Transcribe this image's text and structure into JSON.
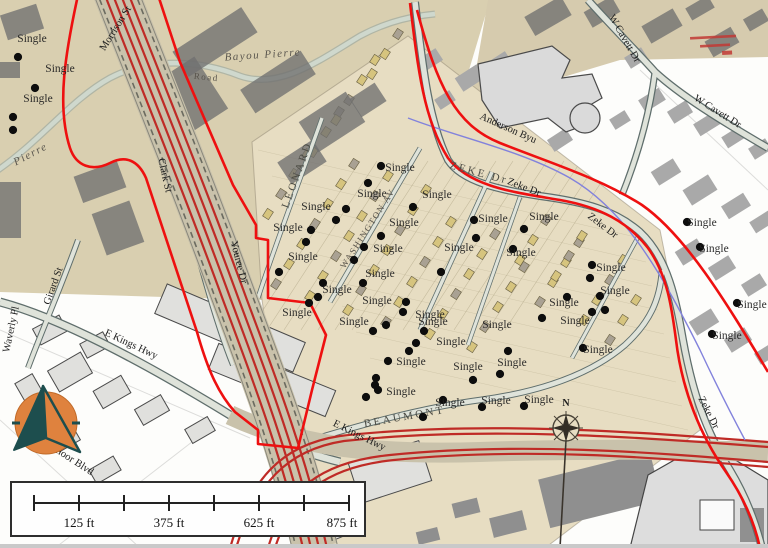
{
  "map": {
    "type": "historic-overlay-gis-map",
    "marker_legend_term": "Single"
  },
  "markers": {
    "label": "Single",
    "points": [
      {
        "x": 18,
        "y": 57,
        "lx": 32,
        "ly": 42
      },
      {
        "x": 35,
        "y": 88,
        "lx": 60,
        "ly": 72
      },
      {
        "x": 13,
        "y": 117,
        "lx": 38,
        "ly": 102
      },
      {
        "x": 13,
        "y": 130
      },
      {
        "x": 381,
        "y": 166,
        "lx": 400,
        "ly": 171
      },
      {
        "x": 368,
        "y": 183,
        "lx": 372,
        "ly": 197
      },
      {
        "x": 336,
        "y": 220,
        "lx": 316,
        "ly": 210
      },
      {
        "x": 346,
        "y": 209
      },
      {
        "x": 413,
        "y": 207,
        "lx": 437,
        "ly": 198
      },
      {
        "x": 381,
        "y": 236,
        "lx": 404,
        "ly": 226
      },
      {
        "x": 311,
        "y": 230,
        "lx": 288,
        "ly": 231
      },
      {
        "x": 306,
        "y": 242
      },
      {
        "x": 279,
        "y": 272,
        "lx": 303,
        "ly": 260
      },
      {
        "x": 364,
        "y": 247,
        "lx": 388,
        "ly": 252
      },
      {
        "x": 354,
        "y": 260
      },
      {
        "x": 441,
        "y": 272,
        "lx": 459,
        "ly": 251
      },
      {
        "x": 474,
        "y": 220,
        "lx": 493,
        "ly": 222
      },
      {
        "x": 476,
        "y": 238
      },
      {
        "x": 363,
        "y": 283,
        "lx": 380,
        "ly": 277
      },
      {
        "x": 323,
        "y": 283,
        "lx": 337,
        "ly": 293
      },
      {
        "x": 318,
        "y": 297
      },
      {
        "x": 406,
        "y": 302,
        "lx": 377,
        "ly": 304
      },
      {
        "x": 403,
        "y": 312,
        "lx": 430,
        "ly": 318
      },
      {
        "x": 309,
        "y": 303,
        "lx": 297,
        "ly": 316
      },
      {
        "x": 373,
        "y": 331,
        "lx": 354,
        "ly": 325
      },
      {
        "x": 386,
        "y": 325
      },
      {
        "x": 424,
        "y": 331,
        "lx": 433,
        "ly": 325
      },
      {
        "x": 416,
        "y": 343
      },
      {
        "x": 508,
        "y": 351,
        "lx": 497,
        "ly": 328
      },
      {
        "x": 409,
        "y": 351,
        "lx": 451,
        "ly": 345
      },
      {
        "x": 388,
        "y": 361,
        "lx": 411,
        "ly": 365
      },
      {
        "x": 376,
        "y": 378
      },
      {
        "x": 473,
        "y": 380,
        "lx": 468,
        "ly": 370
      },
      {
        "x": 500,
        "y": 374,
        "lx": 512,
        "ly": 366
      },
      {
        "x": 378,
        "y": 390,
        "lx": 401,
        "ly": 395
      },
      {
        "x": 366,
        "y": 397
      },
      {
        "x": 443,
        "y": 400,
        "lx": 450,
        "ly": 406
      },
      {
        "x": 482,
        "y": 407,
        "lx": 496,
        "ly": 404
      },
      {
        "x": 524,
        "y": 406,
        "lx": 539,
        "ly": 403
      },
      {
        "x": 423,
        "y": 417
      },
      {
        "x": 375,
        "y": 385
      },
      {
        "x": 524,
        "y": 229,
        "lx": 544,
        "ly": 220
      },
      {
        "x": 513,
        "y": 249,
        "lx": 521,
        "ly": 256
      },
      {
        "x": 592,
        "y": 265,
        "lx": 611,
        "ly": 271
      },
      {
        "x": 590,
        "y": 278
      },
      {
        "x": 600,
        "y": 296,
        "lx": 615,
        "ly": 294
      },
      {
        "x": 567,
        "y": 297,
        "lx": 564,
        "ly": 306
      },
      {
        "x": 542,
        "y": 318,
        "lx": 575,
        "ly": 324
      },
      {
        "x": 592,
        "y": 312
      },
      {
        "x": 605,
        "y": 310
      },
      {
        "x": 687,
        "y": 222,
        "lx": 702,
        "ly": 226
      },
      {
        "x": 700,
        "y": 247,
        "lx": 714,
        "ly": 252
      },
      {
        "x": 737,
        "y": 303,
        "lx": 752,
        "ly": 308
      },
      {
        "x": 712,
        "y": 334,
        "lx": 727,
        "ly": 339
      },
      {
        "x": 583,
        "y": 348,
        "lx": 598,
        "ly": 353
      }
    ]
  },
  "street_labels": [
    {
      "t": "Morrison St",
      "x": 118,
      "y": 30,
      "r": -58,
      "cls": "modern"
    },
    {
      "t": "Bayou Pierre",
      "x": 263,
      "y": 58,
      "r": -4,
      "cls": "hist-italic"
    },
    {
      "t": "Road",
      "x": 206,
      "y": 80,
      "r": 6,
      "cls": "hist-sm"
    },
    {
      "t": "Pierre",
      "x": 32,
      "y": 157,
      "r": -28,
      "cls": "hist-italic"
    },
    {
      "t": "Clark St",
      "x": 162,
      "y": 176,
      "r": 77,
      "cls": "modern"
    },
    {
      "t": "LEONARD",
      "x": 300,
      "y": 176,
      "r": -70,
      "cls": "hist"
    },
    {
      "t": "WASHINGTON AV",
      "x": 370,
      "y": 230,
      "r": -57,
      "cls": "hist-sm"
    },
    {
      "t": "ZEKE  Dr",
      "x": 478,
      "y": 176,
      "r": 15,
      "cls": "hist"
    },
    {
      "t": "Zeke Dr",
      "x": 523,
      "y": 190,
      "r": 21,
      "cls": "modern"
    },
    {
      "t": "Zeke Dr",
      "x": 601,
      "y": 228,
      "r": 37,
      "cls": "modern"
    },
    {
      "t": "Zeke Dr",
      "x": 706,
      "y": 414,
      "r": 63,
      "cls": "modern"
    },
    {
      "t": "Anderson Byu",
      "x": 507,
      "y": 131,
      "r": 24,
      "cls": "modern"
    },
    {
      "t": "W Cavett Dr",
      "x": 622,
      "y": 40,
      "r": 60,
      "cls": "modern"
    },
    {
      "t": "W Cavett Dr",
      "x": 716,
      "y": 114,
      "r": 32,
      "cls": "modern"
    },
    {
      "t": "Girard St",
      "x": 56,
      "y": 287,
      "r": -70,
      "cls": "modern"
    },
    {
      "t": "Waverly Pl",
      "x": 14,
      "y": 330,
      "r": -78,
      "cls": "modern"
    },
    {
      "t": "E Kings Hwy",
      "x": 130,
      "y": 347,
      "r": 25,
      "cls": "modern"
    },
    {
      "t": "E Kings Hwy",
      "x": 358,
      "y": 438,
      "r": 26,
      "cls": "modern"
    },
    {
      "t": "Youree Dr",
      "x": 236,
      "y": 263,
      "r": 76,
      "cls": "modern"
    },
    {
      "t": "BEAUMONT",
      "x": 405,
      "y": 420,
      "r": -10,
      "cls": "hist"
    },
    {
      "t": "moor Blvd",
      "x": 72,
      "y": 463,
      "r": 33,
      "cls": "modern"
    }
  ],
  "scale_bar": {
    "labels": [
      "125 ft",
      "375 ft",
      "625 ft",
      "875 ft"
    ],
    "tick_count": 8
  },
  "compass": {
    "letter": "N"
  },
  "colors": {
    "boundary_red": "#ee1010",
    "highway_red": "#bf2b26",
    "bayou_blue": "#8282dc",
    "road_casing": "#5f6e6c",
    "road_fill": "#dfe3da",
    "tan_sheet": "#ddd2b4",
    "tan_sheet_light": "#e7ddc2",
    "logo_orange": "#df823e",
    "logo_teal": "#1d4e4e"
  }
}
